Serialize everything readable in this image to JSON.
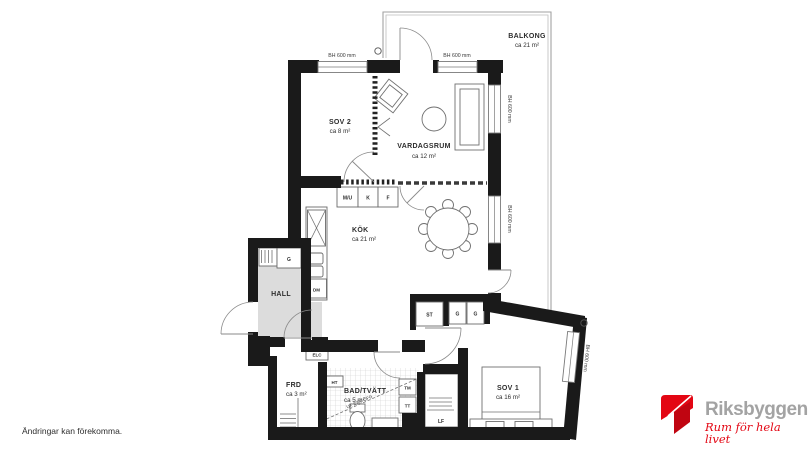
{
  "footer": {
    "disclaimer": "Ändringar kan förekomma."
  },
  "brand": {
    "name": "Riksbyggen",
    "tagline": "Rum för hela livet",
    "color_red": "#e30613",
    "color_gray": "#a3a3a3"
  },
  "plan": {
    "rooms": {
      "balkong": {
        "name": "BALKONG",
        "area": "ca 21 m²"
      },
      "sov2": {
        "name": "SOV 2",
        "area": "ca 8 m²"
      },
      "vardagsrum": {
        "name": "VARDAGSRUM",
        "area": "ca 12 m²"
      },
      "kok": {
        "name": "KÖK",
        "area": "ca 21 m²"
      },
      "hall": {
        "name": "HALL"
      },
      "frd": {
        "name": "FRD",
        "area": "ca 3 m²"
      },
      "bad": {
        "name": "BAD/TVÄTT",
        "area": "ca 5 m²"
      },
      "sov1": {
        "name": "SOV 1",
        "area": "ca 16 m²"
      }
    },
    "labels": {
      "bh": "BH 600 mm",
      "mu": "M/U",
      "k": "K",
      "f": "F",
      "dm": "DM",
      "g": "G",
      "st": "ST",
      "elc": "ELC",
      "ht": "HT",
      "tm": "TM",
      "tt": "TT",
      "lf": "LF",
      "ceiling_note": "UK 2300 ÖFG"
    },
    "colors": {
      "wall": "#1a1a1a",
      "hall_floor": "#dcdcdc",
      "balcony_line": "#a2a2a2"
    }
  }
}
